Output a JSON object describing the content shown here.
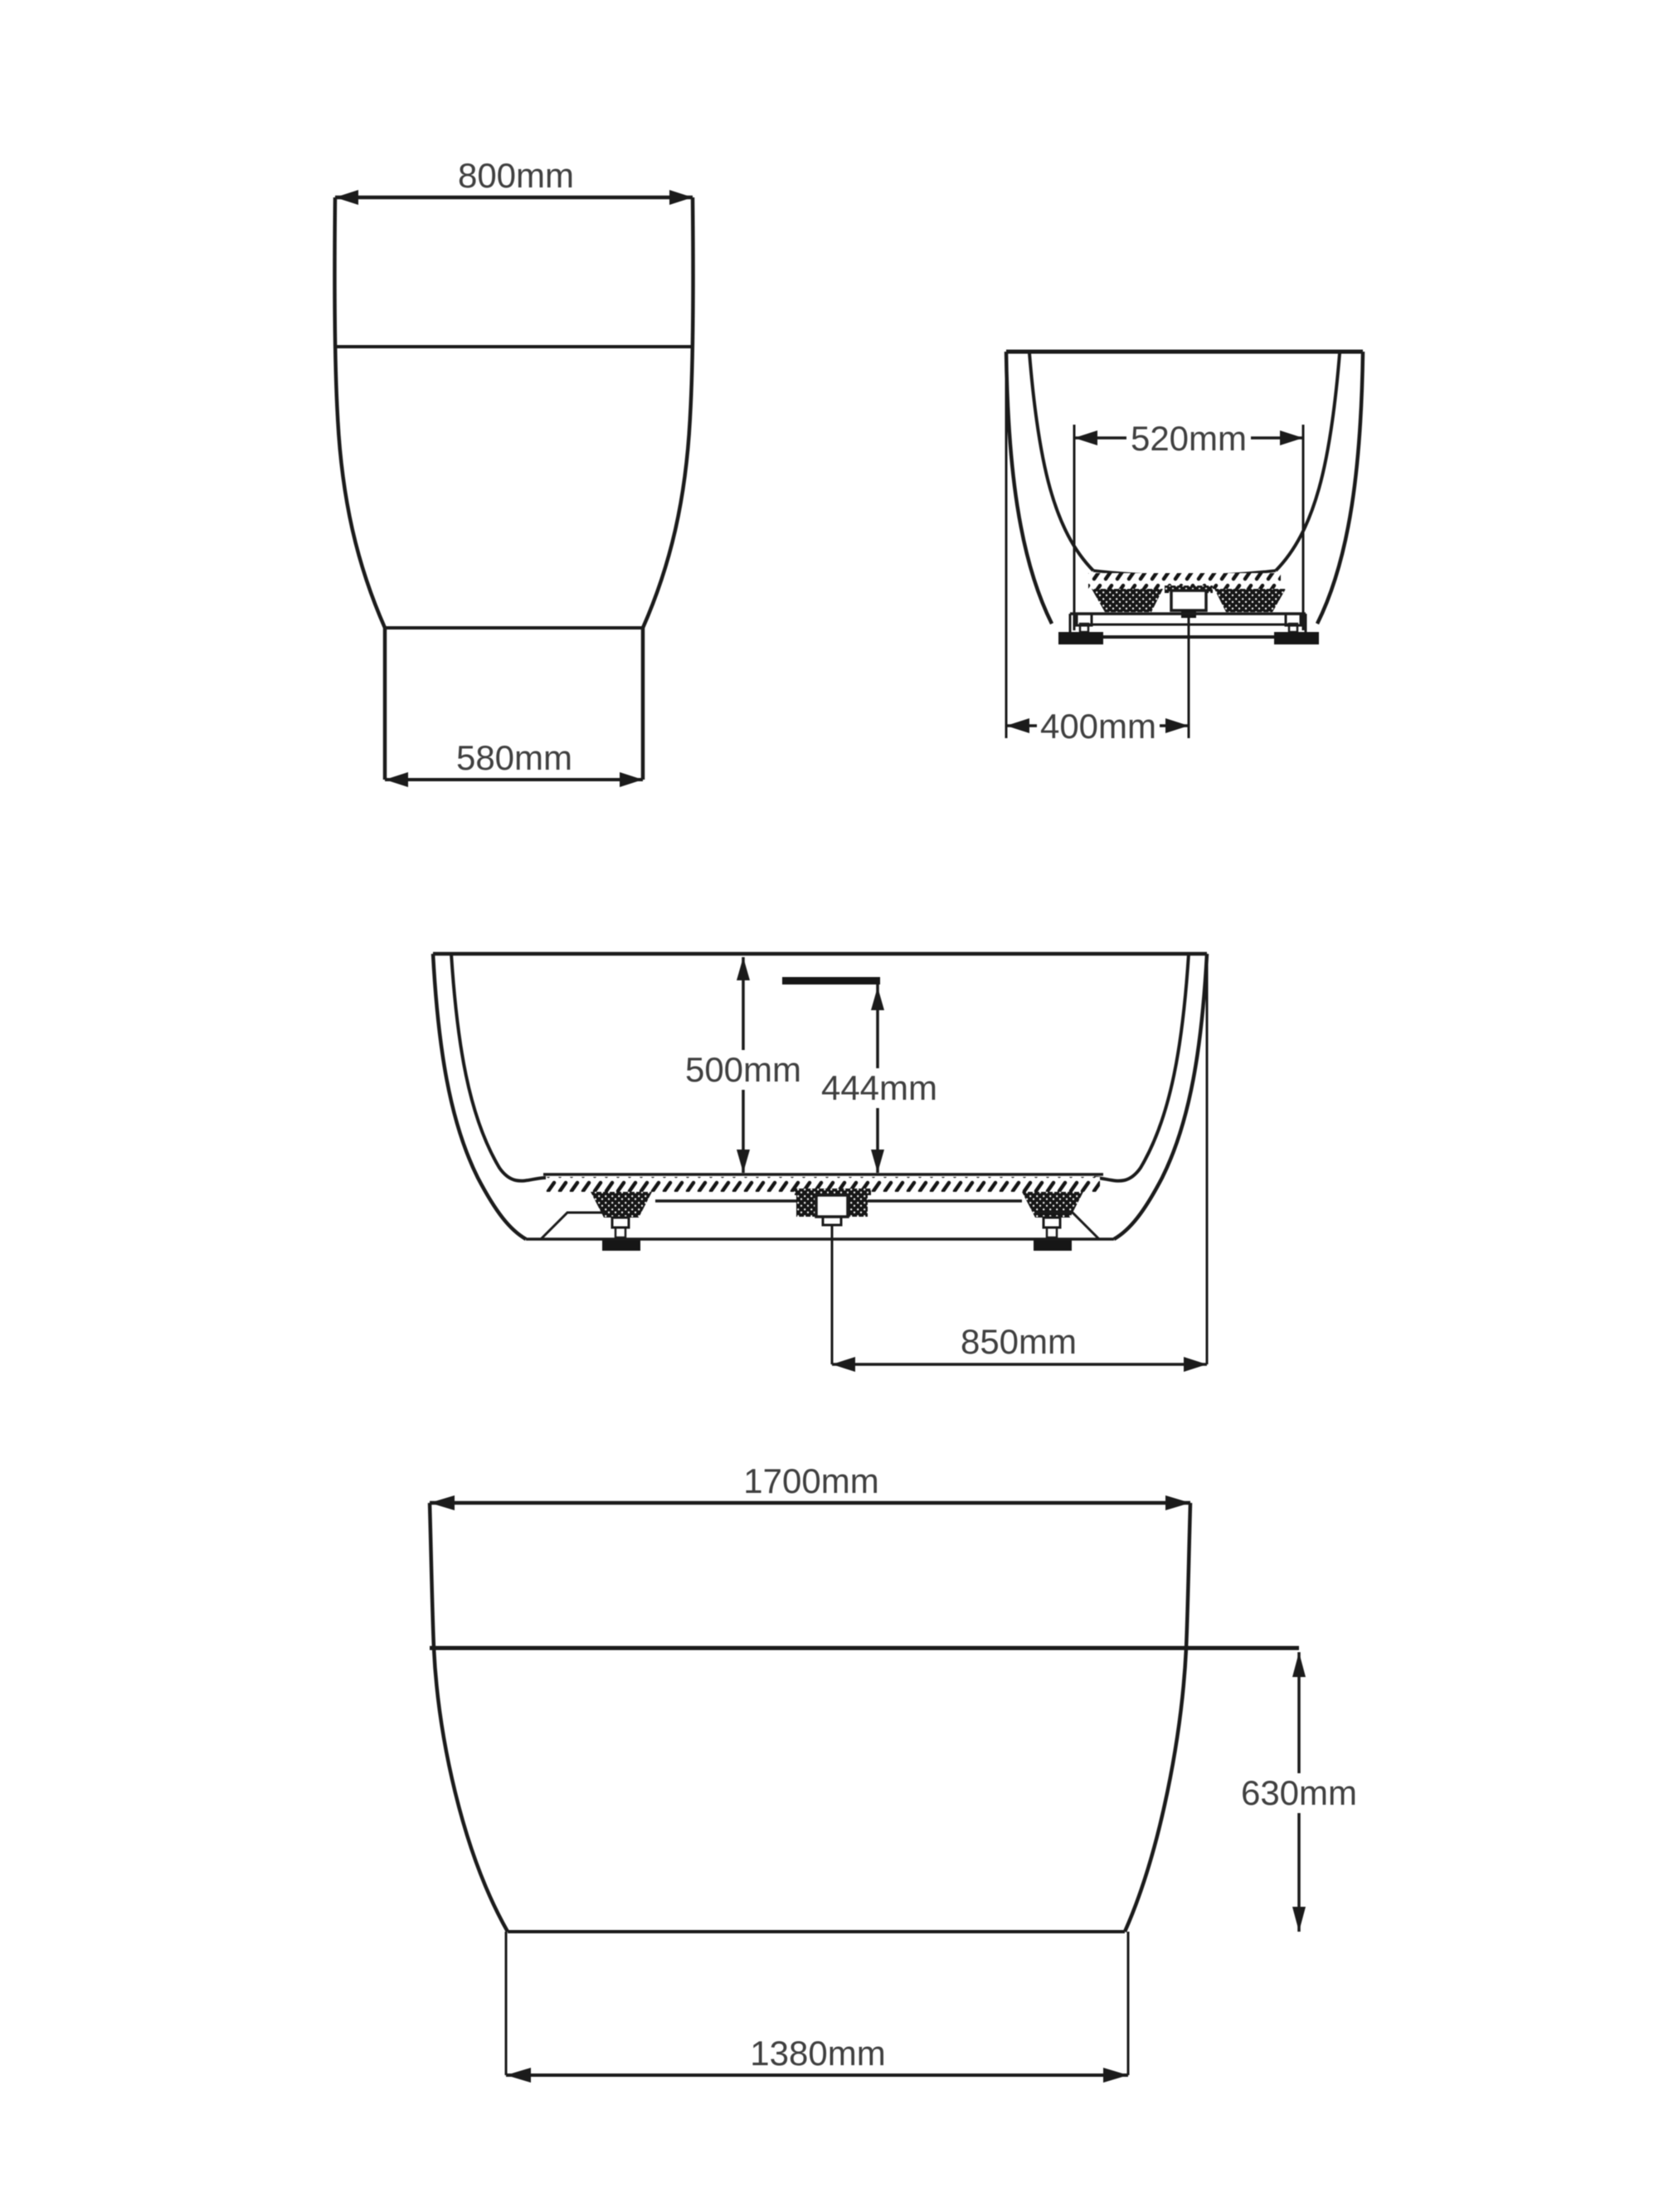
{
  "page": {
    "background": "#ffffff",
    "line_color": "#1b1b1b",
    "text_color": "#3f3f3f",
    "unit": "mm"
  },
  "diagram": {
    "subject": "bathtub-dimension-technical-drawing",
    "views": {
      "front_end": {
        "name": "front end elevation",
        "width_top": "800mm",
        "width_base": "580mm"
      },
      "section_end": {
        "name": "end cross-section",
        "inner_width": "520mm",
        "drain_center_offset": "400mm"
      },
      "section_side": {
        "name": "side cross-section",
        "depth_rim": "500mm",
        "depth_overflow": "444mm",
        "drain_to_end": "850mm"
      },
      "side_elevation": {
        "name": "side elevation",
        "length_overall": "1700mm",
        "height_waterline": "630mm",
        "length_base": "1380mm"
      }
    }
  }
}
